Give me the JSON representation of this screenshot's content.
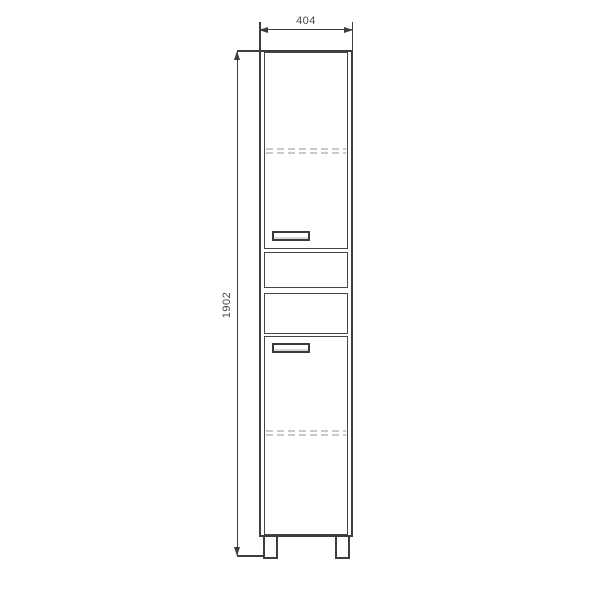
{
  "drawing": {
    "kind": "furniture-front-elevation",
    "dimension_labels": {
      "width": "404",
      "height": "1902"
    },
    "colors": {
      "line": "#3d3d3d",
      "hidden_line": "#c9c9c9",
      "label_text": "#4a4a4a",
      "background": "#ffffff"
    },
    "elements": {
      "doors": 2,
      "drawers": 2,
      "handles": 2,
      "hidden_shelf_lines": 2,
      "legs": 2
    }
  }
}
